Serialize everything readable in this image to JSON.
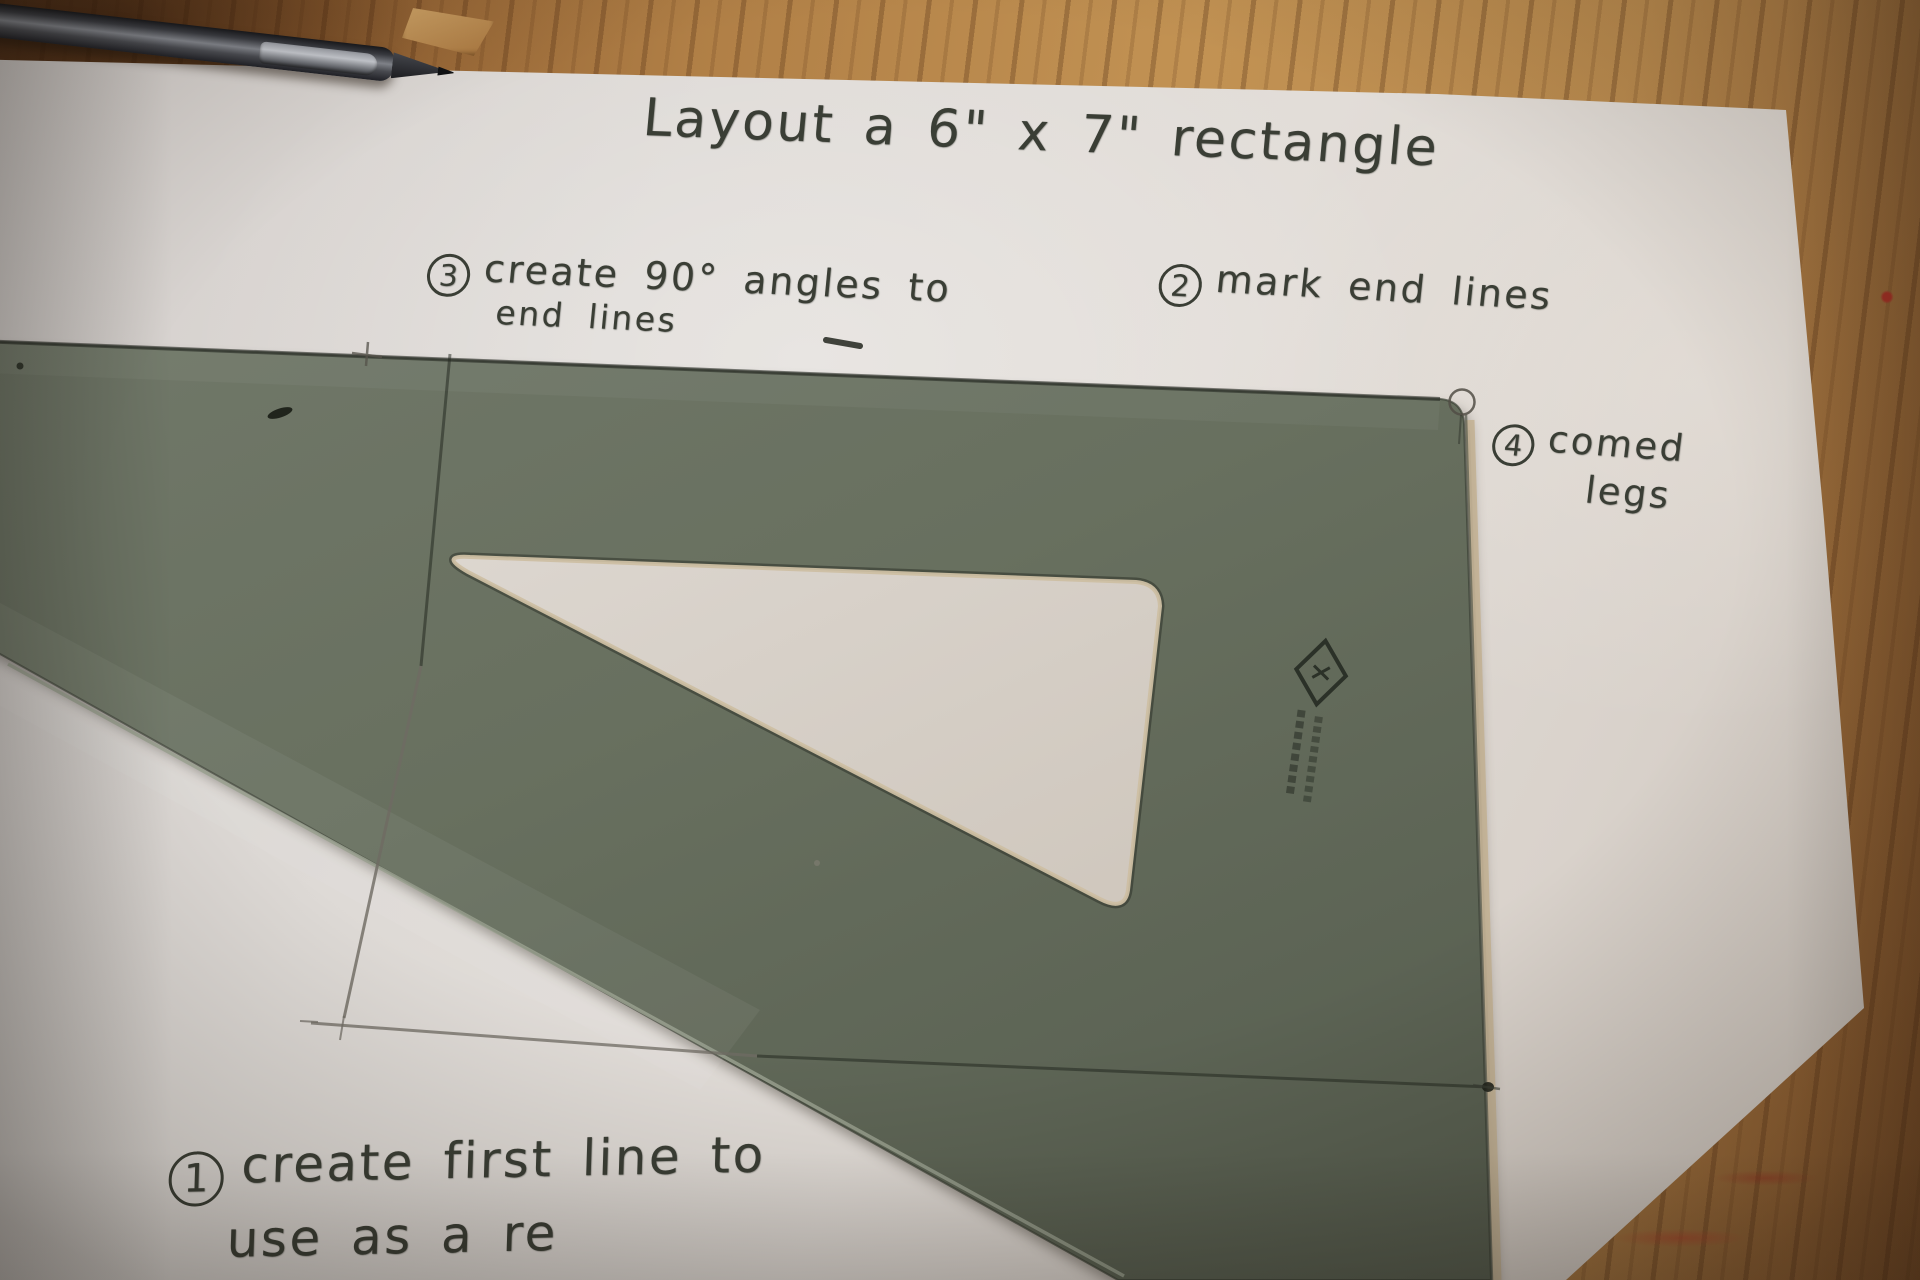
{
  "photo": {
    "title": "Layout a 6\" x 7\" rectangle",
    "steps": {
      "one": {
        "num": "1",
        "line1": "create first line to",
        "line2": "use as a re"
      },
      "two": {
        "num": "2",
        "line1": "mark end lines"
      },
      "three": {
        "num": "3",
        "line1": "create 90° angles to",
        "line2": "end lines"
      },
      "four": {
        "num": "4",
        "line1": "comed",
        "line2": "legs"
      }
    },
    "objects": {
      "triangle_brand_mark": "diamond-logo"
    },
    "colors": {
      "plastic_gray": "#68705f",
      "paper_white": "#dedad6",
      "wood_tan": "#b07f46",
      "marker_ink": "#3a3e35",
      "pencil_line": "#6f6b63",
      "bevel_tan": "#c3b192"
    }
  }
}
